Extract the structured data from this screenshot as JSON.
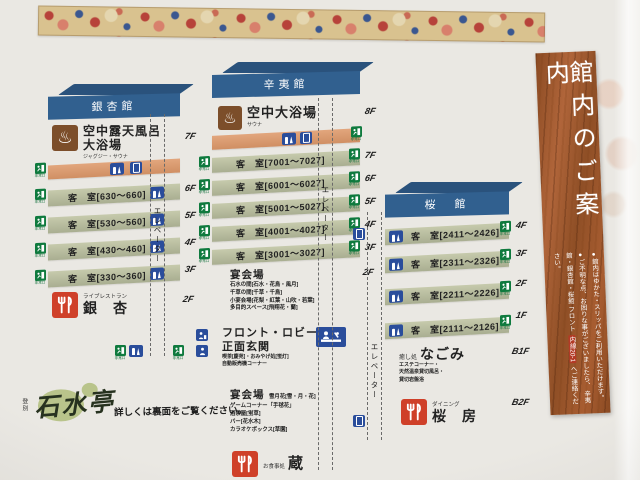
{
  "banner": {
    "title": "館内のご案内",
    "note1": "●館内はゆかた・スリッパをご利用いただけます。",
    "note2a": "●ご不明な点、お困りな事がございましたら、",
    "note2b": "辛夷館・銀杏館・桜館 フロント",
    "note2_ext": "内線20-1",
    "note2c": "へご連絡ください。"
  },
  "legend": {
    "elevator": "エレベーター",
    "exit": "非常口",
    "vending": "自販機"
  },
  "icons": {
    "onsen_glyph": "♨"
  },
  "colors": {
    "roof_blue": "#31608f",
    "bath_band": "#d99b72",
    "guest_band": "#b7bd9e",
    "banquet_yellow": "#ecd96f",
    "front_blue": "#9db7d6",
    "relax_pink": "#e7b5ae",
    "exit_green": "#0f7a3e",
    "icon_blue": "#2a4d9b",
    "restaurant_red": "#cf4029",
    "banner_wood": "#a85d31"
  },
  "buildings": [
    {
      "name": "銀杏館",
      "floors": [
        {
          "label": "7F",
          "title1": "空中露天風呂",
          "title2": "大浴場",
          "subtitle": "ジャグジー・サウナ"
        },
        {
          "label": "6F",
          "rooms": "客　室[630〜660]"
        },
        {
          "label": "5F",
          "rooms": "客　室[530〜560]"
        },
        {
          "label": "4F",
          "rooms": "客　室[430〜460]"
        },
        {
          "label": "3F",
          "rooms": "客　室[330〜360]"
        },
        {
          "label": "2F",
          "subtitle": "ライブレストラン",
          "title": "銀　杏"
        }
      ]
    },
    {
      "name": "辛夷館",
      "floors": [
        {
          "label": "8F",
          "title": "空中大浴場",
          "subtitle": "サウナ"
        },
        {
          "label": "7F",
          "rooms": "客　室[7001〜7027]"
        },
        {
          "label": "6F",
          "rooms": "客　室[6001〜6027]"
        },
        {
          "label": "5F",
          "rooms": "客　室[5001〜5027]"
        },
        {
          "label": "4F",
          "rooms": "客　室[4001〜4027]"
        },
        {
          "label": "3F",
          "rooms": "客　室[3001〜3027]"
        },
        {
          "label": "2F",
          "title": "宴会場",
          "line1": "石水の間[石水・花鳥・風月]",
          "line2": "千草の間[千草・千鳥]",
          "line3": "小宴会場[花梨・紅葉・山吹・若葉]",
          "line4": "多目的スペース[飛翔花・蘭]"
        },
        {
          "label": "1F",
          "title1": "フロント・ロビー・",
          "title2": "正面玄関",
          "line1": "喫茶[慶苑]・おみやげ処[蛍灯]",
          "line2": "自動販売機コーナー"
        },
        {
          "label": "B1F",
          "title": "宴会場",
          "note": "雪月花[雪・月・花]",
          "line1": "ゲームコーナー「手毬花」",
          "line2": "酒茶屋[蛍草]",
          "line3": "バー[花水木]",
          "line4": "カラオケボックス[草園]"
        },
        {
          "label": "B2F",
          "subtitle": "お食事処",
          "title": "蔵"
        }
      ]
    },
    {
      "name": "桜　館",
      "floors": [
        {
          "label": "4F",
          "rooms": "客　室[2411〜2426]"
        },
        {
          "label": "3F",
          "rooms": "客　室[2311〜2326]"
        },
        {
          "label": "2F",
          "rooms": "客　室[2211〜2226]"
        },
        {
          "label": "1F",
          "rooms": "客　室[2111〜2126]"
        },
        {
          "label": "B1F",
          "subtitle": "癒し処",
          "title": "なごみ",
          "line1": "エステコーナー・",
          "line2": "天然温泉貸切風呂・",
          "line3": "貸切岩盤浴"
        },
        {
          "label": "B2F",
          "subtitle": "ダイニング",
          "title": "桜　房"
        }
      ]
    }
  ],
  "brand": {
    "area": "登別",
    "name": "石水亭",
    "note": "詳しくは裏面をご覧ください。"
  }
}
